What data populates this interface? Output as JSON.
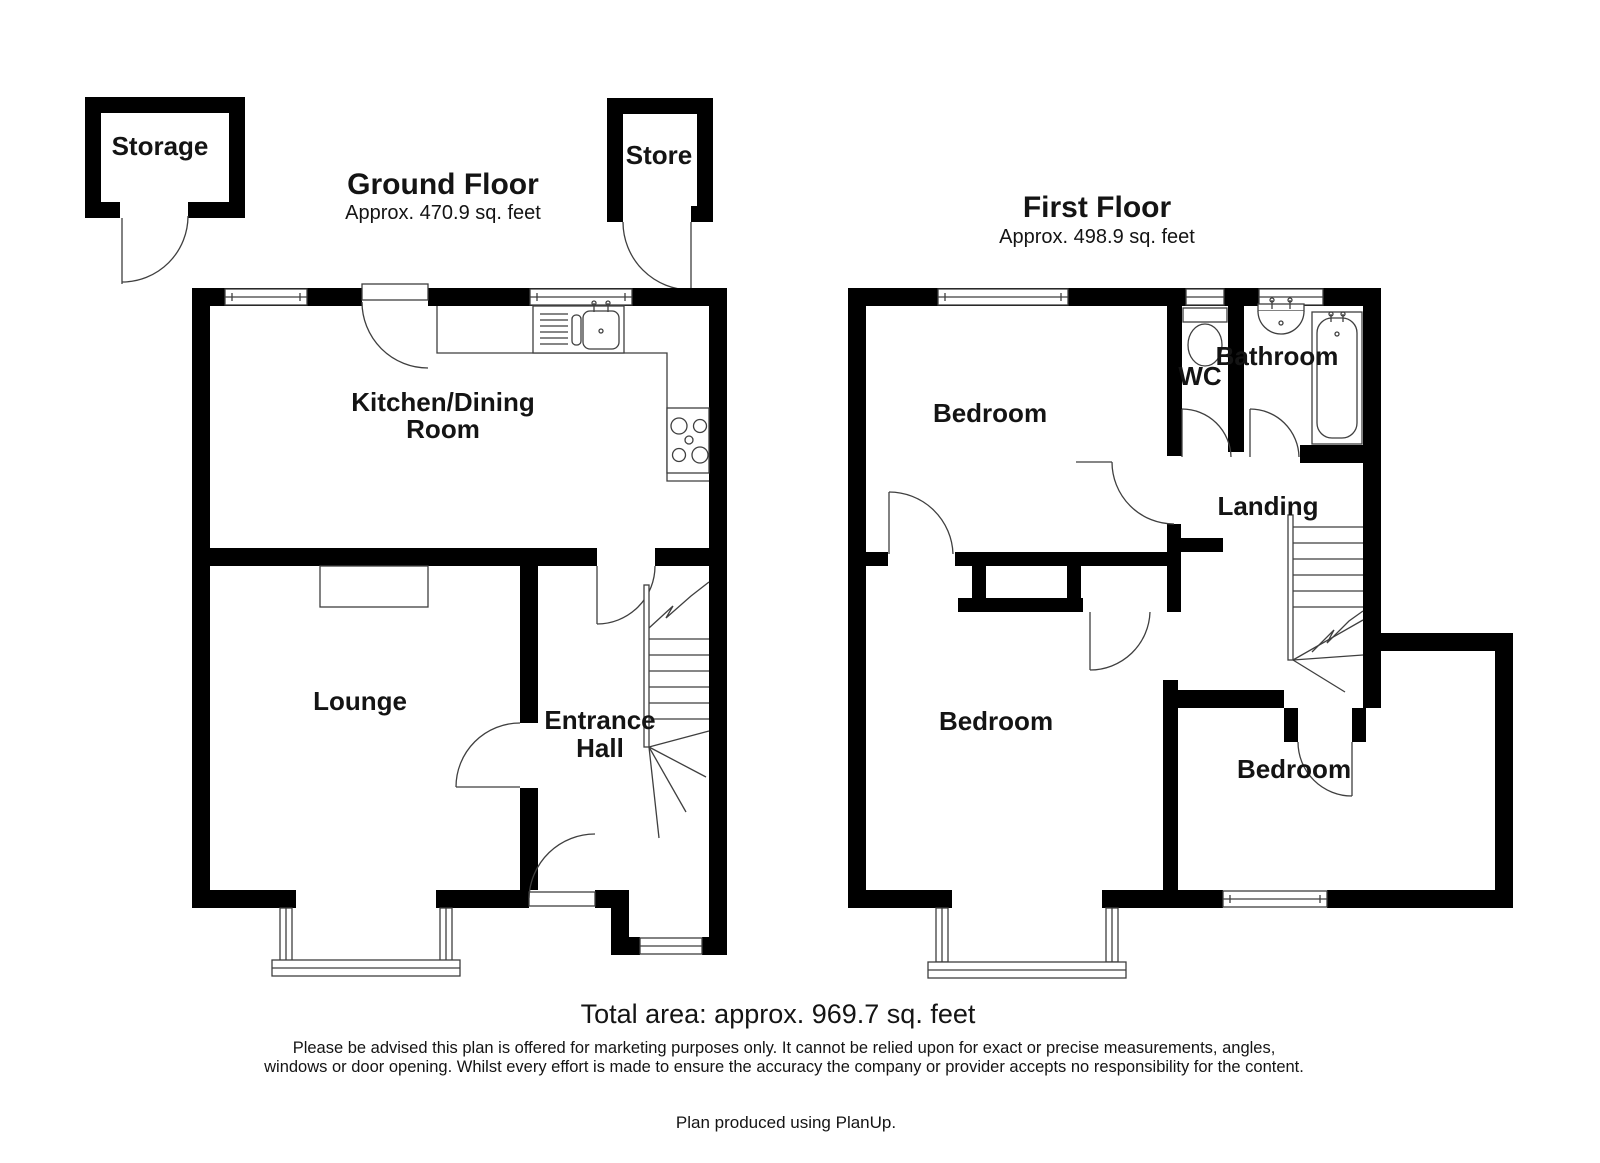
{
  "ground_floor": {
    "title": "Ground Floor",
    "area": "Approx. 470.9 sq. feet",
    "rooms": {
      "storage": "Storage",
      "store": "Store",
      "kitchen_line1": "Kitchen/Dining",
      "kitchen_line2": "Room",
      "lounge": "Lounge",
      "hall_line1": "Entrance",
      "hall_line2": "Hall"
    }
  },
  "first_floor": {
    "title": "First Floor",
    "area": "Approx. 498.9 sq. feet",
    "rooms": {
      "bedroom_top": "Bedroom",
      "wc": "WC",
      "bathroom": "Bathroom",
      "landing": "Landing",
      "bedroom_left": "Bedroom",
      "bedroom_right": "Bedroom"
    }
  },
  "footer": {
    "total_area": "Total area: approx. 969.7 sq. feet",
    "disclaimer_line1": "Please be advised this plan is offered for marketing purposes only. It cannot be relied upon for exact or precise measurements, angles,",
    "disclaimer_line2": "windows or door opening. Whilst every effort is made to ensure the accuracy the company or provider accepts no responsibility for the content.",
    "credit": "Plan produced using PlanUp."
  },
  "colors": {
    "wall": "#000000",
    "line": "#3f3f3f",
    "text": "#141414",
    "background": "#ffffff"
  }
}
